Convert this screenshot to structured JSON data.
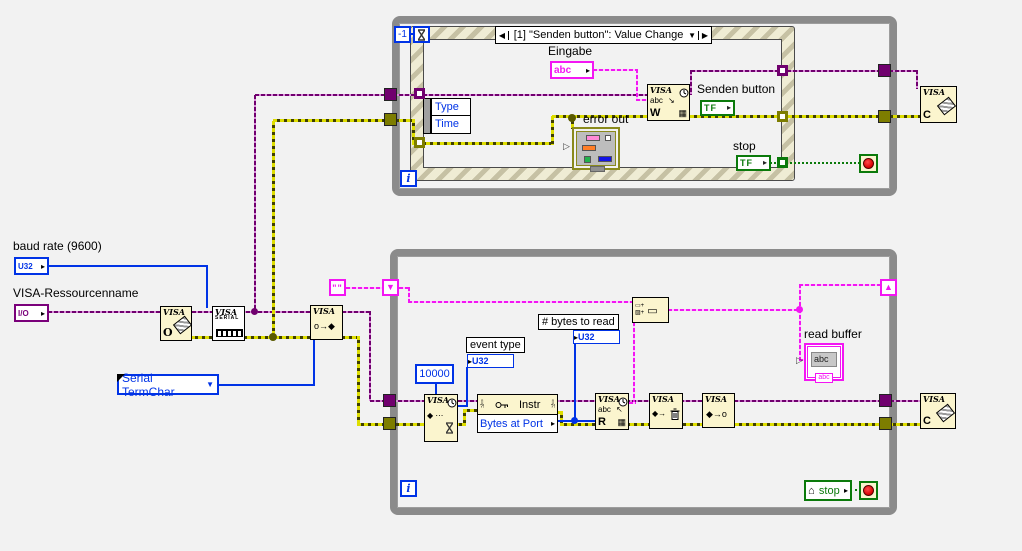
{
  "colors": {
    "canvas_bg": "#f2f2f2",
    "loop_border": "#8b8b8b",
    "structure_hatch_light": "#efecd4",
    "structure_hatch_dark": "#c6c1a4",
    "node_bg": "#fbf5ce",
    "visa_wire_purple": "#70006e",
    "string_wire_pink": "#f316f3",
    "error_wire_dark": "#3f3f00",
    "error_wire_light": "#dede00",
    "numeric_wire_blue": "#0033e6",
    "boolean_wire_green": "#0b7a0b",
    "stop_red": "#d90000"
  },
  "icons": {
    "case_prev": "◀",
    "case_next": "▶",
    "dropdown": "▼",
    "output_arrow": "▸",
    "input_arrow": "▸",
    "left_arrow_out": "▷",
    "shift_reg_down": "▼",
    "shift_reg_up": "▲",
    "house": "⌂",
    "grid": "▦",
    "write_arrow": "↘",
    "read_arrow": "↖",
    "concat_top": "▭+",
    "concat_bottom": "▨+",
    "concat_out": "▭"
  },
  "left_panel": {
    "baud_rate_label": "baud rate (9600)",
    "baud_rate_terminal": "U32",
    "visa_resource_label": "VISA-Ressourcenname",
    "visa_resource_terminal": "I/O",
    "termchar_enum": "Serial TermChar"
  },
  "nodes": {
    "visa_open": {
      "title": "VISA",
      "letter": "O"
    },
    "visa_serial": {
      "title": "VISA",
      "subtitle": "SERIAL"
    },
    "visa_enable_event": {
      "title": "VISA",
      "glyph": "o→◆"
    },
    "visa_wait_event": {
      "title": "VISA",
      "glyph": "◆ ⋯"
    },
    "property_node": {
      "class_label": "Instr",
      "property": "Bytes at Port",
      "err_glyph": "?!"
    },
    "visa_read": {
      "title": "VISA",
      "glyph": "abc",
      "letter": "R"
    },
    "visa_write": {
      "title": "VISA",
      "glyph": "abc",
      "letter": "W"
    },
    "visa_discard_events": {
      "title": "VISA",
      "glyph": "◆→"
    },
    "visa_unmap": {
      "title": "VISA",
      "glyph": "◆→o"
    },
    "visa_close_top": {
      "title": "VISA",
      "letter": "C"
    },
    "visa_close_bottom": {
      "title": "VISA",
      "letter": "C"
    }
  },
  "top_loop": {
    "timeout_constant": "-1",
    "event_case_label": "[1] \"Senden button\": Value Change",
    "eingabe_label": "Eingabe",
    "eingabe_terminal": "abc",
    "event_data_rows": [
      "Type",
      "Time"
    ],
    "error_out_label": "error out",
    "senden_button_label": "Senden button",
    "senden_button_terminal": "TF",
    "stop_label": "stop",
    "stop_terminal": "TF",
    "iteration_terminal": "i"
  },
  "bottom_loop": {
    "empty_string_constant": "\"\"",
    "timeout_constant": "10000",
    "event_type_label": "event type",
    "event_type_terminal": "U32",
    "bytes_to_read_label": "# bytes to read",
    "bytes_to_read_terminal": "U32",
    "read_buffer_label": "read buffer",
    "read_buffer_text": "abc",
    "read_buffer_tag": "abc",
    "stop_local_label": "stop",
    "iteration_terminal": "i"
  }
}
